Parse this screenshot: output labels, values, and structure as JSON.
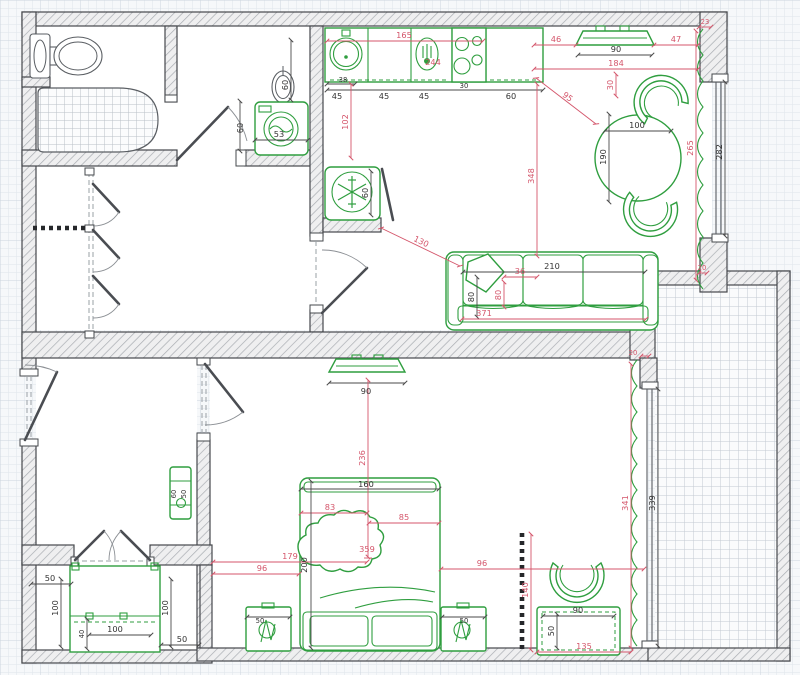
{
  "drawing": {
    "type": "apartment-floor-plan"
  },
  "colors": {
    "furniture_green": "#2f9e3f",
    "dimension_red": "#d4566b",
    "dimension_dark": "#333333",
    "wall_outline": "#45484c",
    "grid_line": "#dfe5eb"
  },
  "dims": {
    "bathroom": {
      "door_height": "60",
      "washer_width": "53",
      "washer_offset": "60"
    },
    "kitchen": {
      "counter_total": "165",
      "mixer": "244",
      "sink_offset": "38",
      "cabinet_1": "45",
      "cabinet_2": "45",
      "cabinet_3": "45",
      "stove_width": "30",
      "cabinet_4": "60",
      "counter_depth_gap": "102",
      "fridge_width": "60",
      "fridge_to_sofa": "130",
      "counter_to_sofa": "348"
    },
    "dining": {
      "tv_left_gap": "46",
      "tv_width": "90",
      "tv_right_gap": "47",
      "room_width": "184",
      "corner_gap": "23",
      "tv_to_table": "30",
      "counter_to_table": "95",
      "table_diameter": "100",
      "table_zone": "190",
      "curtain_length": "265",
      "window_length": "282",
      "curtain_end_gap": "20"
    },
    "sofa": {
      "width": "210",
      "cushion": "36",
      "depth": "80",
      "depth_inner": "80",
      "total_width": "371"
    },
    "bedroom": {
      "tv_width": "90",
      "tv_to_bed": "236",
      "bed_width": "160",
      "bed_length": "200",
      "pillow_offset": "83",
      "side_offset": "85",
      "center_offset": "359",
      "wall_to_center": "179",
      "left_gap": "96",
      "right_gap": "96",
      "nightstand_left": "50",
      "nightstand_right": "50",
      "door_gap": "20",
      "curtain_length": "341",
      "window_length": "339",
      "radiator": "140",
      "desk_width": "90",
      "desk_depth": "50",
      "desk_to_wall": "135"
    },
    "small_room": {
      "table_width": "60",
      "table_depth": "50"
    },
    "balcony": {
      "left_gap": "50",
      "side_left": "100",
      "side_right": "100",
      "wardrobe_depth": "40",
      "wardrobe_width": "100",
      "right_gap": "50"
    }
  }
}
